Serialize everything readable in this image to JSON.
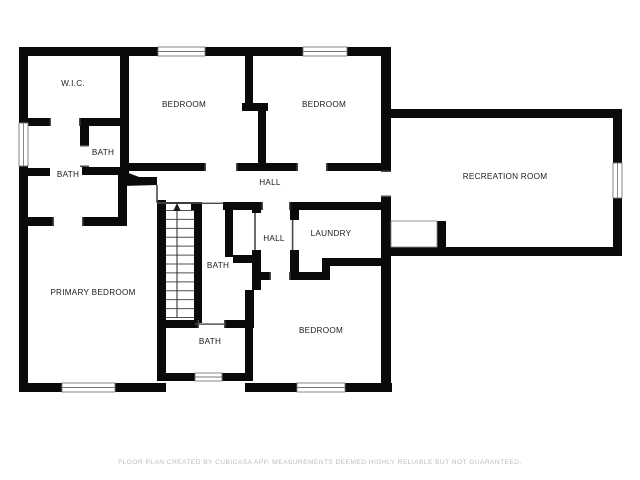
{
  "page": {
    "background": "#ffffff",
    "width": 640,
    "height": 480
  },
  "palette": {
    "wall": "#0a0a0a",
    "label": "#1c1c1c",
    "window_line": "#7a7a7a",
    "footer": "#bdbdbd"
  },
  "floorplan": {
    "rooms": [
      {
        "id": "wic",
        "label": "W.I.C.",
        "x": 73,
        "y": 86
      },
      {
        "id": "bedroom-1",
        "label": "BEDROOM",
        "x": 184,
        "y": 107
      },
      {
        "id": "bedroom-2",
        "label": "BEDROOM",
        "x": 324,
        "y": 107
      },
      {
        "id": "recreation-room",
        "label": "RECREATION ROOM",
        "x": 505,
        "y": 179
      },
      {
        "id": "bath-small",
        "label": "BATH",
        "x": 103,
        "y": 155
      },
      {
        "id": "bath-left",
        "label": "BATH",
        "x": 68,
        "y": 177
      },
      {
        "id": "hall-upper",
        "label": "HALL",
        "x": 270,
        "y": 185
      },
      {
        "id": "hall-lower",
        "label": "HALL",
        "x": 274,
        "y": 241
      },
      {
        "id": "laundry",
        "label": "LAUNDRY",
        "x": 331,
        "y": 236
      },
      {
        "id": "bath-middle",
        "label": "BATH",
        "x": 218,
        "y": 268
      },
      {
        "id": "primary-bedroom",
        "label": "PRIMARY BEDROOM",
        "x": 93,
        "y": 295
      },
      {
        "id": "bedroom-3",
        "label": "BEDROOM",
        "x": 321,
        "y": 333
      },
      {
        "id": "bath-lower",
        "label": "BATH",
        "x": 210,
        "y": 344
      }
    ],
    "stairs": {
      "direction": "up",
      "treads": 13
    },
    "window_count": 7
  },
  "footer": {
    "text": "FLOOR PLAN CREATED BY CUBICASA APP. MEASUREMENTS DEEMED HIGHLY RELIABLE BUT NOT GUARANTEED."
  }
}
